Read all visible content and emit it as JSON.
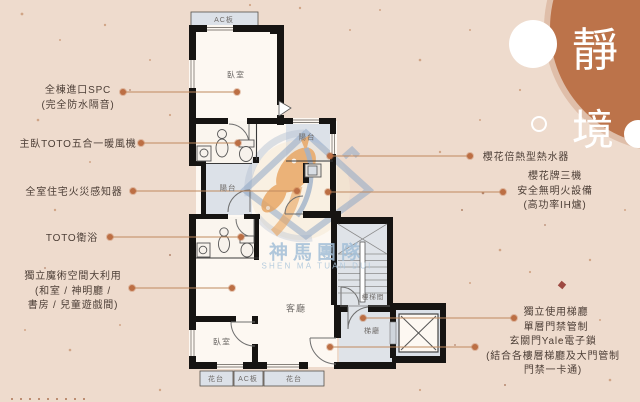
{
  "title": {
    "text": "靜境",
    "chars": [
      "靜",
      "境"
    ]
  },
  "watermark": {
    "name": "神馬團隊",
    "latin": "SHEN MA TUAN DUI"
  },
  "plan_labels": {
    "ac_top": "AC板",
    "bedroom_top": "臥室",
    "balcony_right": "陽台",
    "balcony_mid": "陽台",
    "living": "客廳",
    "bedroom_bottom": "臥室",
    "stairwell": "樓梯間",
    "hall": "梯廳",
    "flower_left": "花台",
    "ac_bottom": "AC板",
    "flower_right": "花台"
  },
  "callouts_left": [
    {
      "lines": [
        "全棟進口SPC",
        "(完全防水隔音)"
      ]
    },
    {
      "lines": [
        "主臥TOTO五合一暖風機"
      ]
    },
    {
      "lines": [
        "全室住宅火災感知器"
      ]
    },
    {
      "lines": [
        "TOTO衛浴"
      ]
    },
    {
      "lines": [
        "獨立魔術空間大利用",
        "(和室 / 神明廳 /",
        "書房 / 兒童遊戲間)"
      ]
    }
  ],
  "callouts_right": [
    {
      "lines": [
        "櫻花倍熱型熱水器"
      ]
    },
    {
      "lines": [
        "櫻花牌三機",
        "安全無明火設備",
        "(高功率IH爐)"
      ]
    },
    {
      "lines": [
        "獨立使用梯廳",
        "單層門禁管制"
      ]
    },
    {
      "lines": [
        "玄關門Yale電子鎖",
        "(結合各樓層梯廳及大門管制",
        "門禁一卡通)"
      ]
    }
  ],
  "colors": {
    "background": "#eedbcd",
    "accent_circle": "#bc734a",
    "label_text": "#4c3e36",
    "wall": "#161412",
    "wet_floor": "#dce1e8",
    "room_floor": "#fdf8f2",
    "callout_line": "#c08a5e",
    "callout_dot": "#bc6f44",
    "watermark_blue": "#8fa7c6",
    "watermark_orange": "#e8a35e"
  }
}
